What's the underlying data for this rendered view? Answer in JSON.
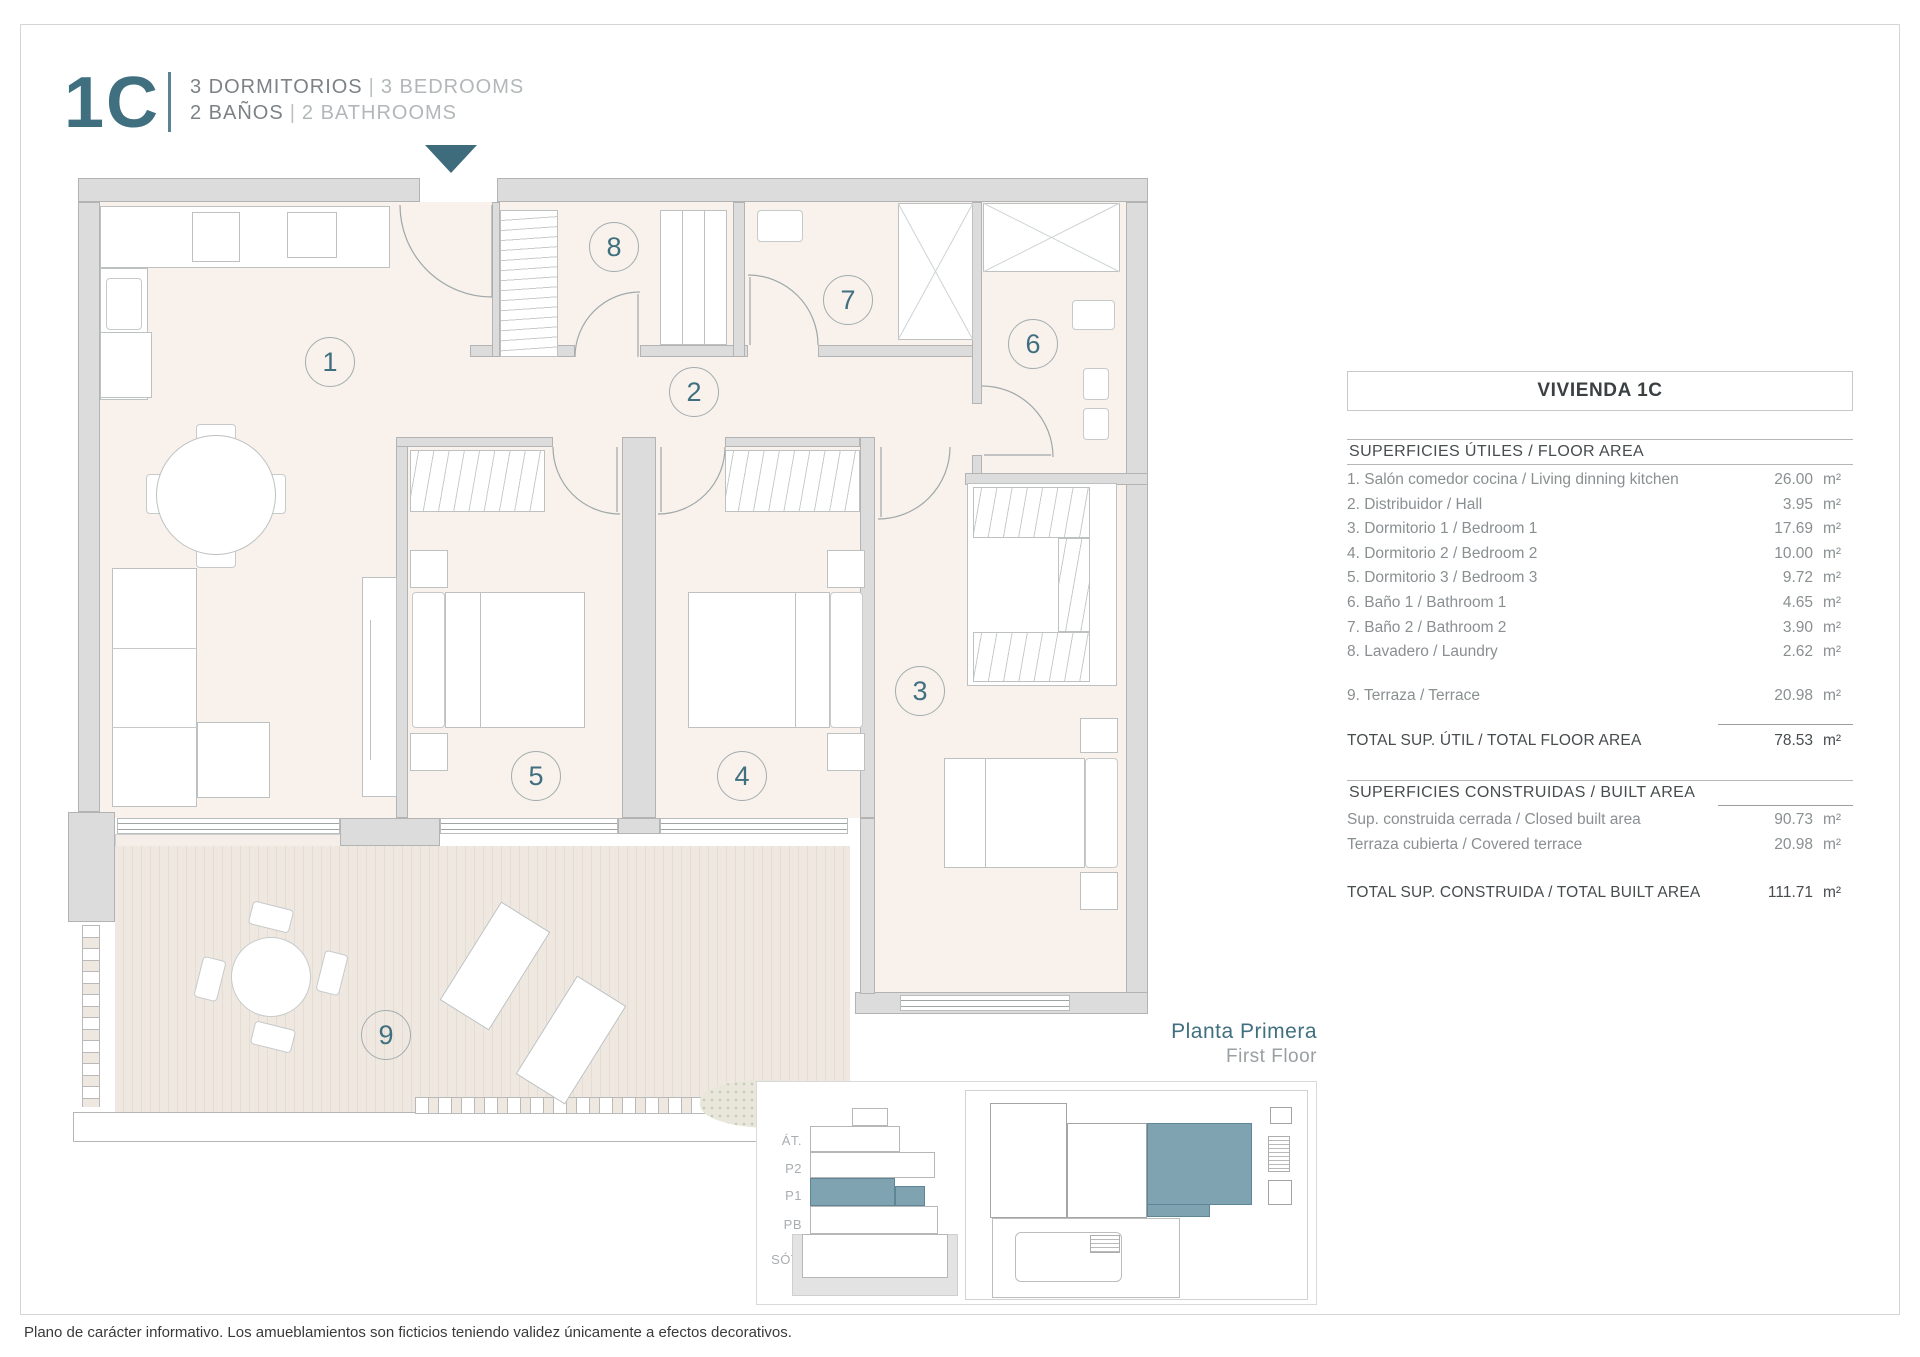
{
  "header": {
    "unit_code": "1C",
    "bedrooms_es": "3 DORMITORIOS",
    "bedrooms_en": "3 BEDROOMS",
    "bathrooms_es": "2 BAÑOS",
    "bathrooms_en": "2 BATHROOMS",
    "separator": "|"
  },
  "floor_label": {
    "es": "Planta Primera",
    "en": "First Floor"
  },
  "disclaimer": "Plano de carácter informativo. Los amueblamientos son ficticios teniendo validez únicamente a efectos decorativos.",
  "colors": {
    "accent": "#40707f",
    "keyplan_highlight": "#7fa3b1",
    "wall": "#dcdcdc",
    "floor": "#f8f1ec",
    "deck": "#efe8e1"
  },
  "floorplan": {
    "rooms": [
      {
        "number": "1",
        "x": 330,
        "y": 362
      },
      {
        "number": "2",
        "x": 694,
        "y": 392
      },
      {
        "number": "8",
        "x": 614,
        "y": 247
      },
      {
        "number": "7",
        "x": 848,
        "y": 300
      },
      {
        "number": "6",
        "x": 1033,
        "y": 344
      },
      {
        "number": "5",
        "x": 536,
        "y": 776
      },
      {
        "number": "4",
        "x": 742,
        "y": 776
      },
      {
        "number": "3",
        "x": 920,
        "y": 691
      },
      {
        "number": "9",
        "x": 386,
        "y": 1035
      }
    ]
  },
  "area_table": {
    "title": "VIVIENDA 1C",
    "sections": [
      {
        "header": "SUPERFICIES ÚTILES / FLOOR AREA",
        "rows": [
          {
            "label": "1. Salón comedor cocina / Living dinning kitchen",
            "value": "26.00",
            "unit": "m²"
          },
          {
            "label": "2. Distribuidor / Hall",
            "value": "3.95",
            "unit": "m²"
          },
          {
            "label": "3. Dormitorio 1 / Bedroom 1",
            "value": "17.69",
            "unit": "m²"
          },
          {
            "label": "4. Dormitorio 2 / Bedroom 2",
            "value": "10.00",
            "unit": "m²"
          },
          {
            "label": "5. Dormitorio 3 / Bedroom 3",
            "value": "9.72",
            "unit": "m²"
          },
          {
            "label": "6. Baño 1 / Bathroom 1",
            "value": "4.65",
            "unit": "m²"
          },
          {
            "label": "7. Baño 2 / Bathroom 2",
            "value": "3.90",
            "unit": "m²"
          },
          {
            "label": "8. Lavadero / Laundry",
            "value": "2.62",
            "unit": "m²"
          }
        ],
        "extra_row": {
          "label": "9. Terraza / Terrace",
          "value": "20.98",
          "unit": "m²"
        },
        "total": {
          "label": "TOTAL SUP. ÚTIL / TOTAL FLOOR AREA",
          "value": "78.53",
          "unit": "m²"
        }
      },
      {
        "header": "SUPERFICIES CONSTRUIDAS / BUILT AREA",
        "rows": [
          {
            "label": "Sup. construida cerrada / Closed built area",
            "value": "90.73",
            "unit": "m²"
          },
          {
            "label": "Terraza cubierta / Covered terrace",
            "value": "20.98",
            "unit": "m²"
          }
        ],
        "total": {
          "label": "TOTAL SUP. CONSTRUIDA /  TOTAL BUILT AREA",
          "value": "111.71",
          "unit": "m²"
        }
      }
    ]
  },
  "keyplan": {
    "levels": [
      "ÁT.",
      "P2",
      "P1",
      "PB",
      "SÓT."
    ],
    "highlighted_level": "P1"
  }
}
